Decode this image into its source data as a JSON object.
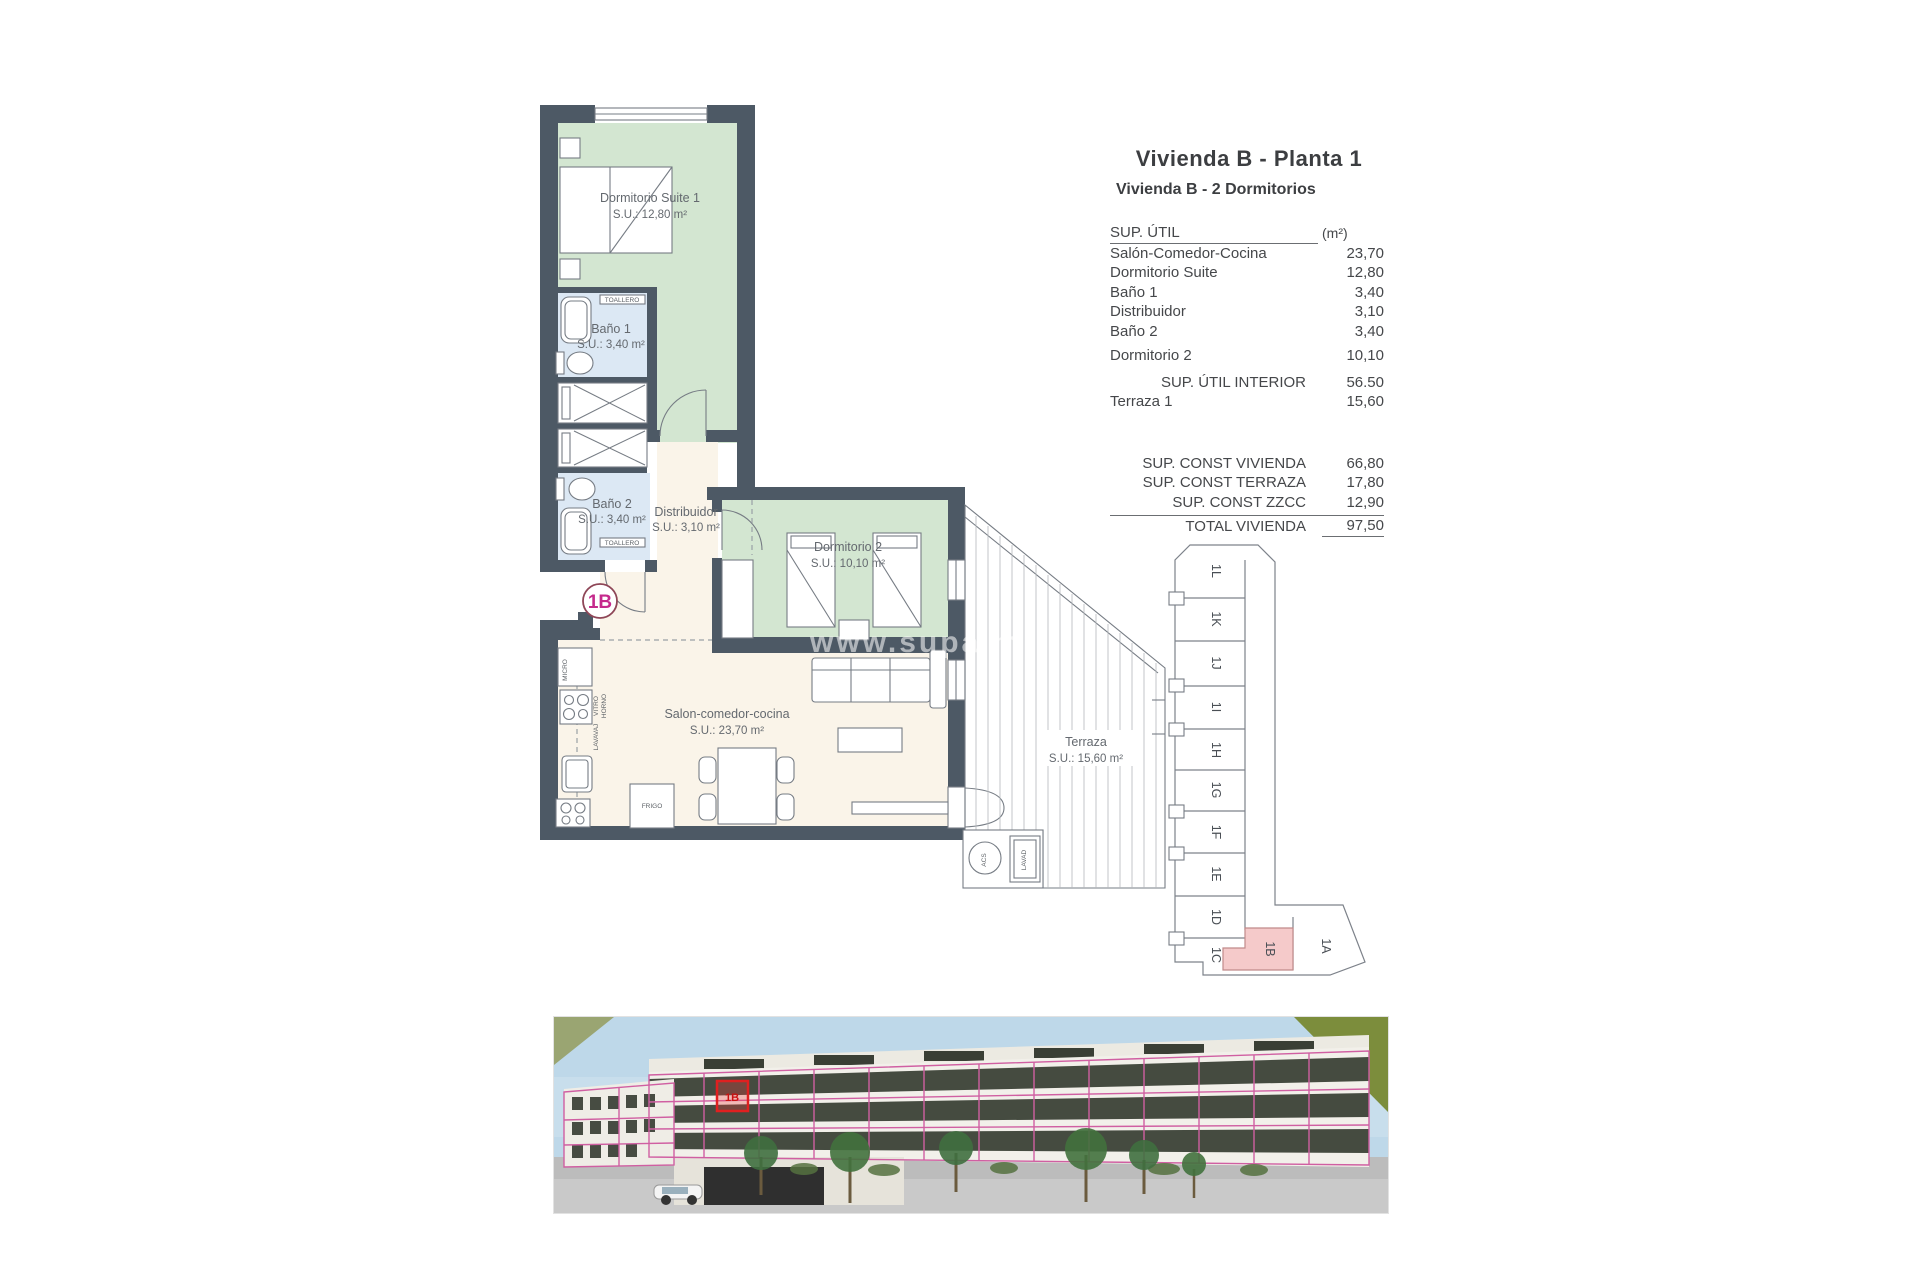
{
  "header": {
    "title": "Vivienda B - Planta 1",
    "subtitle": "Vivienda B - 2 Dormitorios"
  },
  "area_table": {
    "header_label": "SUP. ÚTIL",
    "header_unit": "(m²)",
    "rows": [
      {
        "label": "Salón-Comedor-Cocina",
        "value": "23,70"
      },
      {
        "label": "Dormitorio Suite",
        "value": "12,80"
      },
      {
        "label": "Baño 1",
        "value": "3,40"
      },
      {
        "label": "Distribuidor",
        "value": "3,10"
      },
      {
        "label": "Baño 2",
        "value": "3,40"
      },
      {
        "label": "Dormitorio 2",
        "value": "10,10"
      }
    ],
    "subtotal": {
      "label": "SUP. ÚTIL INTERIOR",
      "value": "56.50"
    },
    "terraza_row": {
      "label": "Terraza 1",
      "value": "15,60"
    },
    "const_rows": [
      {
        "label": "SUP. CONST VIVIENDA",
        "value": "66,80"
      },
      {
        "label": "SUP. CONST TERRAZA",
        "value": "17,80"
      },
      {
        "label": "SUP. CONST ZZCC",
        "value": "12,90"
      }
    ],
    "total": {
      "label": "TOTAL VIVIENDA",
      "value": "97,50"
    }
  },
  "plan": {
    "unit_badge": "1B",
    "watermark": "www.supalm",
    "rooms": {
      "suite": {
        "name": "Dormitorio Suite 1",
        "area": "S.U.: 12,80 m²"
      },
      "bano1": {
        "name": "Baño 1",
        "area": "S.U.: 3,40 m²"
      },
      "bano2": {
        "name": "Baño 2",
        "area": "S.U.: 3,40 m²"
      },
      "distribuidor": {
        "name": "Distribuidor",
        "area": "S.U.: 3,10 m²"
      },
      "dorm2": {
        "name": "Dormitorio 2",
        "area": "S.U.: 10,10 m²"
      },
      "salon": {
        "name": "Salon-comedor-cocina",
        "area": "S.U.: 23,70 m²"
      },
      "terraza": {
        "name": "Terraza",
        "area": "S.U.: 15,60 m²"
      }
    },
    "fixtures": {
      "toallero": "TOALLERO",
      "micro": "MICRO",
      "vitro": "VITRO",
      "horno": "HORNO",
      "lavavaj": "LAVAVAJ",
      "frigo": "FRIGO",
      "acs": "ACS",
      "lavad": "LAVAD"
    }
  },
  "key_plan": {
    "units": [
      "1L",
      "1K",
      "1J",
      "1I",
      "1H",
      "1G",
      "1F",
      "1E",
      "1D",
      "1C"
    ],
    "highlighted": "1B",
    "unit_a": "1A"
  },
  "photo": {
    "overlay_label": "1B"
  },
  "colors": {
    "wall": "#4d5965",
    "room_green": "#d3e6d1",
    "room_blue": "#dce8f4",
    "room_cream": "#faf4e9",
    "unit_badge_text": "#c52a8c",
    "unit_badge_ring": "#8e4657",
    "keyplan_highlight": "#f5caca",
    "photo_overlay_pink": "#d05fa2",
    "photo_highlight_red": "#e02020"
  }
}
